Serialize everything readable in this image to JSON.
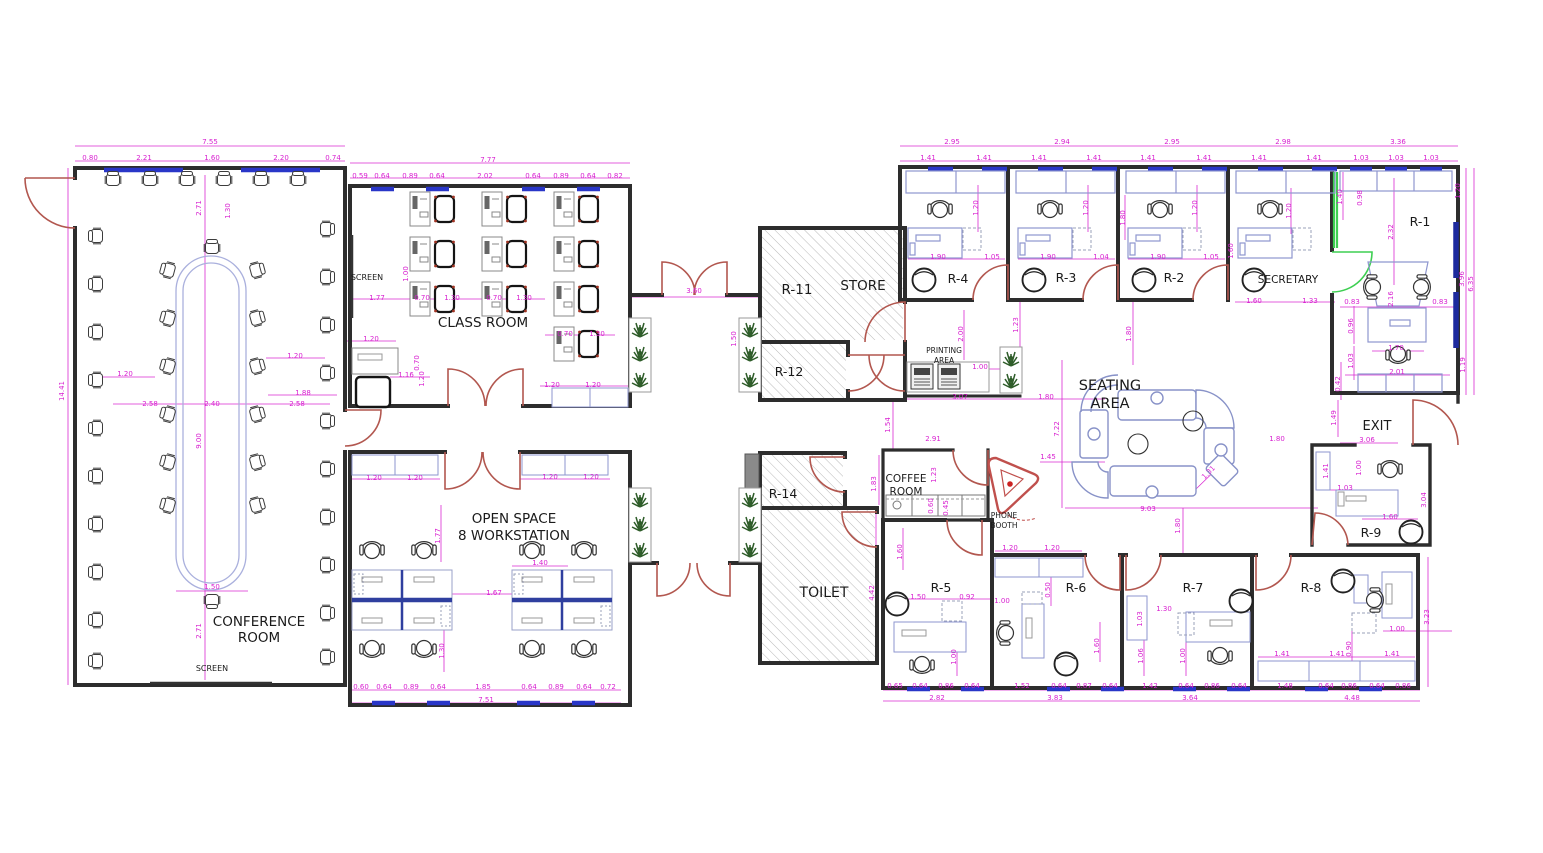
{
  "drawing": {
    "type": "office-floor-plan",
    "colors": {
      "wall": "#2d2d2d",
      "dimension": "#d81fd0",
      "window_blue": "#2936c8",
      "window_dark_blue": "#1d2a9e",
      "door_red": "#b2574f",
      "door_green": "#3ecf52",
      "hatch_gray": "#b9b9b9",
      "plant_green": "#2f5d2a",
      "furniture_blue": "#8e96cf",
      "workstation_divider": "#2f3f9f",
      "sofa_blue": "#8892c8",
      "label_black": "#1a1a1a"
    },
    "labels": [
      {
        "id": "conference-room",
        "text": "CONFERENCE",
        "x": 259,
        "y": 626,
        "size": 13.5
      },
      {
        "id": "conference-room-2",
        "text": "ROOM",
        "x": 259,
        "y": 642,
        "size": 13.5
      },
      {
        "id": "screen-conference",
        "text": "SCREEN",
        "x": 212,
        "y": 671,
        "size": 8
      },
      {
        "id": "screen-classroom",
        "text": "SCREEN",
        "x": 367,
        "y": 280,
        "size": 8
      },
      {
        "id": "class-room",
        "text": "CLASS ROOM",
        "x": 483,
        "y": 327,
        "size": 13.5
      },
      {
        "id": "open-space",
        "text": "OPEN SPACE",
        "x": 514,
        "y": 523,
        "size": 13.5
      },
      {
        "id": "open-space-2",
        "text": "8 WORKSTATION",
        "x": 514,
        "y": 540,
        "size": 13.5
      },
      {
        "id": "room-r11",
        "text": "R-11",
        "x": 797,
        "y": 294,
        "size": 13.5
      },
      {
        "id": "store",
        "text": "STORE",
        "x": 863,
        "y": 290,
        "size": 13.5
      },
      {
        "id": "room-r12",
        "text": "R-12",
        "x": 789,
        "y": 376,
        "size": 12.5
      },
      {
        "id": "room-r14",
        "text": "R-14",
        "x": 783,
        "y": 498,
        "size": 12.5
      },
      {
        "id": "toilet",
        "text": "TOILET",
        "x": 824,
        "y": 597,
        "size": 14
      },
      {
        "id": "coffee-room",
        "text": "COFFEE",
        "x": 906,
        "y": 482,
        "size": 10.5
      },
      {
        "id": "coffee-room-2",
        "text": "ROOM",
        "x": 906,
        "y": 495,
        "size": 10.5
      },
      {
        "id": "phone-booth",
        "text": "PHONE",
        "x": 1004,
        "y": 518,
        "size": 7.5
      },
      {
        "id": "phone-booth-2",
        "text": "BOOTH",
        "x": 1004,
        "y": 528,
        "size": 7.5
      },
      {
        "id": "printing-area",
        "text": "PRINTING",
        "x": 944,
        "y": 353,
        "size": 7.5
      },
      {
        "id": "printing-area-2",
        "text": "AREA",
        "x": 944,
        "y": 363,
        "size": 7.5
      },
      {
        "id": "seating-area",
        "text": "SEATING",
        "x": 1110,
        "y": 390,
        "size": 14.5
      },
      {
        "id": "seating-area-2",
        "text": "AREA",
        "x": 1110,
        "y": 408,
        "size": 14.5
      },
      {
        "id": "secretary",
        "text": "SECRETARY",
        "x": 1288,
        "y": 283,
        "size": 10.5
      },
      {
        "id": "room-r4",
        "text": "R-4",
        "x": 958,
        "y": 283,
        "size": 12.5
      },
      {
        "id": "room-r3",
        "text": "R-3",
        "x": 1066,
        "y": 282,
        "size": 12.5
      },
      {
        "id": "room-r2",
        "text": "R-2",
        "x": 1174,
        "y": 282,
        "size": 12.5
      },
      {
        "id": "room-r1",
        "text": "R-1",
        "x": 1420,
        "y": 226,
        "size": 12.5
      },
      {
        "id": "room-r5",
        "text": "R-5",
        "x": 941,
        "y": 592,
        "size": 12.5
      },
      {
        "id": "room-r6",
        "text": "R-6",
        "x": 1076,
        "y": 592,
        "size": 12.5
      },
      {
        "id": "room-r7",
        "text": "R-7",
        "x": 1193,
        "y": 592,
        "size": 12.5
      },
      {
        "id": "room-r8",
        "text": "R-8",
        "x": 1311,
        "y": 592,
        "size": 12.5
      },
      {
        "id": "room-r9",
        "text": "R-9",
        "x": 1371,
        "y": 537,
        "size": 12.5
      },
      {
        "id": "exit",
        "text": "EXIT",
        "x": 1377,
        "y": 430,
        "size": 13
      }
    ],
    "dims": [
      [
        "7.55",
        210,
        144
      ],
      [
        "0.80",
        90,
        160
      ],
      [
        "2.21",
        144,
        160
      ],
      [
        "1.60",
        212,
        160
      ],
      [
        "2.20",
        281,
        160
      ],
      [
        "0.74",
        333,
        160
      ],
      [
        "2.71",
        201,
        208,
        -90
      ],
      [
        "1.30",
        230,
        211,
        -90
      ],
      [
        "1.20",
        125,
        376
      ],
      [
        "2.58",
        150,
        406
      ],
      [
        "2.40",
        212,
        406
      ],
      [
        "2.58",
        297,
        406
      ],
      [
        "1.20",
        295,
        358
      ],
      [
        "1.88",
        303,
        395
      ],
      [
        "9.00",
        201,
        441,
        -90
      ],
      [
        "14.41",
        64,
        391,
        -90
      ],
      [
        "1.50",
        212,
        589
      ],
      [
        "2.71",
        201,
        631,
        -90
      ],
      [
        "7.77",
        488,
        162
      ],
      [
        "0.59",
        360,
        178
      ],
      [
        "0.64",
        382,
        178
      ],
      [
        "0.89",
        410,
        178
      ],
      [
        "0.64",
        437,
        178
      ],
      [
        "2.02",
        485,
        178
      ],
      [
        "0.64",
        533,
        178
      ],
      [
        "0.89",
        561,
        178
      ],
      [
        "0.64",
        588,
        178
      ],
      [
        "0.82",
        615,
        178
      ],
      [
        "1.00",
        408,
        274,
        -90
      ],
      [
        "1.77",
        377,
        300
      ],
      [
        "0.70",
        422,
        300
      ],
      [
        "1.30",
        452,
        300
      ],
      [
        "0.70",
        494,
        300
      ],
      [
        "1.30",
        524,
        300
      ],
      [
        "0.70",
        565,
        336
      ],
      [
        "1.30",
        597,
        336
      ],
      [
        "1.20",
        371,
        341
      ],
      [
        "0.70",
        419,
        363,
        -90
      ],
      [
        "1.16",
        406,
        377
      ],
      [
        "1.20",
        424,
        379,
        -90
      ],
      [
        "1.20",
        552,
        387
      ],
      [
        "1.20",
        593,
        387
      ],
      [
        "3.60",
        694,
        293
      ],
      [
        "1.50",
        736,
        339,
        -90
      ],
      [
        "1.20",
        374,
        480
      ],
      [
        "1.20",
        415,
        480
      ],
      [
        "1.20",
        550,
        479
      ],
      [
        "1.20",
        591,
        479
      ],
      [
        "1.77",
        440,
        536,
        -90
      ],
      [
        "1.40",
        540,
        565
      ],
      [
        "1.67",
        494,
        595
      ],
      [
        "1.30",
        444,
        651,
        -90
      ],
      [
        "0.60",
        361,
        689
      ],
      [
        "0.64",
        384,
        689
      ],
      [
        "0.89",
        411,
        689
      ],
      [
        "0.64",
        438,
        689
      ],
      [
        "1.85",
        483,
        689
      ],
      [
        "0.64",
        529,
        689
      ],
      [
        "0.89",
        556,
        689
      ],
      [
        "0.64",
        584,
        689
      ],
      [
        "0.72",
        608,
        689
      ],
      [
        "7.51",
        486,
        702
      ],
      [
        "2.95",
        952,
        144
      ],
      [
        "1.41",
        928,
        160
      ],
      [
        "1.41",
        984,
        160
      ],
      [
        "2.94",
        1062,
        144
      ],
      [
        "1.41",
        1039,
        160
      ],
      [
        "1.41",
        1094,
        160
      ],
      [
        "2.95",
        1172,
        144
      ],
      [
        "1.41",
        1148,
        160
      ],
      [
        "1.41",
        1204,
        160
      ],
      [
        "2.98",
        1283,
        144
      ],
      [
        "1.41",
        1259,
        160
      ],
      [
        "1.41",
        1314,
        160
      ],
      [
        "3.36",
        1398,
        144
      ],
      [
        "1.03",
        1361,
        160
      ],
      [
        "1.03",
        1396,
        160
      ],
      [
        "1.03",
        1431,
        160
      ],
      [
        "1.20",
        978,
        208,
        -90
      ],
      [
        "1.90",
        938,
        259
      ],
      [
        "1.05",
        992,
        259
      ],
      [
        "1.20",
        1088,
        208,
        -90
      ],
      [
        "1.90",
        1048,
        259
      ],
      [
        "1.04",
        1101,
        259
      ],
      [
        "1.80",
        1125,
        218,
        -90
      ],
      [
        "1.20",
        1197,
        208,
        -90
      ],
      [
        "1.90",
        1158,
        259
      ],
      [
        "1.05",
        1211,
        259
      ],
      [
        "1.20",
        1291,
        211,
        -90
      ],
      [
        "1.60",
        1233,
        251,
        -90
      ],
      [
        "1.60",
        1254,
        303
      ],
      [
        "1.33",
        1310,
        303
      ],
      [
        "1.40",
        1342,
        197,
        -90
      ],
      [
        "0.98",
        1362,
        198,
        -90
      ],
      [
        "2.32",
        1393,
        232,
        -90
      ],
      [
        "1.20",
        1460,
        191,
        -90
      ],
      [
        "3.96",
        1464,
        279,
        -90
      ],
      [
        "6.35",
        1473,
        284,
        -90
      ],
      [
        "0.83",
        1352,
        304
      ],
      [
        "0.83",
        1440,
        304
      ],
      [
        "2.16",
        1393,
        299,
        -90
      ],
      [
        "0.96",
        1353,
        326,
        -90
      ],
      [
        "1.03",
        1353,
        361,
        -90
      ],
      [
        "1.70",
        1396,
        350
      ],
      [
        "2.01",
        1397,
        374
      ],
      [
        "0.42",
        1340,
        384,
        -90
      ],
      [
        "1.19",
        1465,
        365,
        -90
      ],
      [
        "2.00",
        963,
        334,
        -90
      ],
      [
        "1.23",
        1018,
        325,
        -90
      ],
      [
        "1.00",
        980,
        369
      ],
      [
        "3.07",
        960,
        399
      ],
      [
        "1.80",
        1046,
        399
      ],
      [
        "1.80",
        1131,
        334,
        -90
      ],
      [
        "1.54",
        890,
        425,
        -90
      ],
      [
        "7.22",
        1059,
        429,
        -90
      ],
      [
        "1.45",
        1048,
        459
      ],
      [
        "1.31",
        1210,
        474,
        -45
      ],
      [
        "1.80",
        1277,
        441
      ],
      [
        "9.03",
        1148,
        511
      ],
      [
        "1.80",
        1180,
        526,
        -90
      ],
      [
        "2.91",
        933,
        441
      ],
      [
        "1.23",
        936,
        475,
        -90
      ],
      [
        "0.60",
        933,
        506,
        -90
      ],
      [
        "0.45",
        948,
        508,
        -90
      ],
      [
        "1.83",
        876,
        484,
        -90
      ],
      [
        "4.42",
        874,
        593,
        -90
      ],
      [
        "1.49",
        1336,
        418,
        -90
      ],
      [
        "3.06",
        1367,
        442
      ],
      [
        "1.41",
        1328,
        471,
        -90
      ],
      [
        "1.00",
        1361,
        468,
        -90
      ],
      [
        "1.03",
        1345,
        490
      ],
      [
        "1.60",
        1390,
        519
      ],
      [
        "3.04",
        1426,
        500,
        -90
      ],
      [
        "1.60",
        902,
        552,
        -90
      ],
      [
        "1.50",
        918,
        599
      ],
      [
        "0.92",
        967,
        599
      ],
      [
        "1.00",
        956,
        657,
        -90
      ],
      [
        "0.65",
        895,
        688
      ],
      [
        "0.64",
        920,
        688
      ],
      [
        "0.86",
        946,
        688
      ],
      [
        "0.64",
        972,
        688
      ],
      [
        "2.82",
        937,
        700
      ],
      [
        "1.20",
        1010,
        550
      ],
      [
        "1.20",
        1052,
        550
      ],
      [
        "0.50",
        1050,
        590,
        -90
      ],
      [
        "1.00",
        1002,
        603
      ],
      [
        "1.60",
        1099,
        646,
        -90
      ],
      [
        "1.52",
        1022,
        688
      ],
      [
        "0.64",
        1059,
        688
      ],
      [
        "0.87",
        1084,
        688
      ],
      [
        "0.64",
        1110,
        688
      ],
      [
        "3.83",
        1055,
        700
      ],
      [
        "1.30",
        1164,
        611
      ],
      [
        "1.03",
        1142,
        619,
        -90
      ],
      [
        "1.06",
        1143,
        656,
        -90
      ],
      [
        "1.00",
        1185,
        656,
        -90
      ],
      [
        "1.42",
        1150,
        688
      ],
      [
        "0.64",
        1186,
        688
      ],
      [
        "0.86",
        1212,
        688
      ],
      [
        "0.64",
        1239,
        688
      ],
      [
        "3.64",
        1190,
        700
      ],
      [
        "1.41",
        1282,
        656
      ],
      [
        "1.41",
        1337,
        656
      ],
      [
        "1.41",
        1392,
        656
      ],
      [
        "0.90",
        1351,
        649,
        -90
      ],
      [
        "1.00",
        1397,
        631
      ],
      [
        "3.23",
        1429,
        617,
        -90
      ],
      [
        "1.48",
        1285,
        688
      ],
      [
        "0.64",
        1326,
        688
      ],
      [
        "0.86",
        1349,
        688
      ],
      [
        "0.64",
        1377,
        688
      ],
      [
        "0.86",
        1403,
        688
      ],
      [
        "4.48",
        1352,
        700
      ]
    ]
  }
}
